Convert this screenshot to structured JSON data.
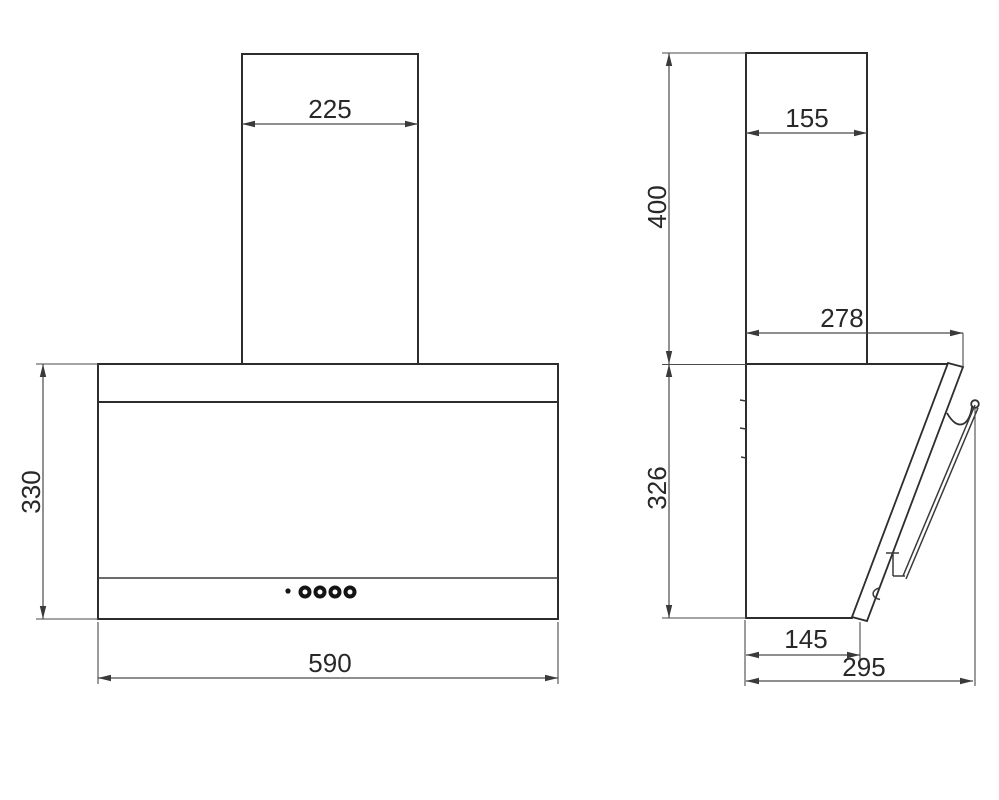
{
  "drawing": {
    "subject": "wall-mounted angled cooker hood - dimension drawing, front and side elevations",
    "units": "mm",
    "views": {
      "front": {
        "name": "front view",
        "dims": {
          "chimney_width": "225",
          "body_height": "330",
          "body_width": "590"
        },
        "controls": {
          "indicator_dots": 1,
          "round_buttons": 4
        }
      },
      "side": {
        "name": "side view",
        "dims": {
          "chimney_depth": "155",
          "chimney_height": "400",
          "top_depth": "278",
          "body_height": "326",
          "bottom_depth": "145",
          "overall_depth": "295"
        }
      }
    },
    "colors": {
      "line": "#2d2d2d",
      "dimension": "#4a4a4a",
      "text": "#282828",
      "background": "#ffffff"
    }
  }
}
